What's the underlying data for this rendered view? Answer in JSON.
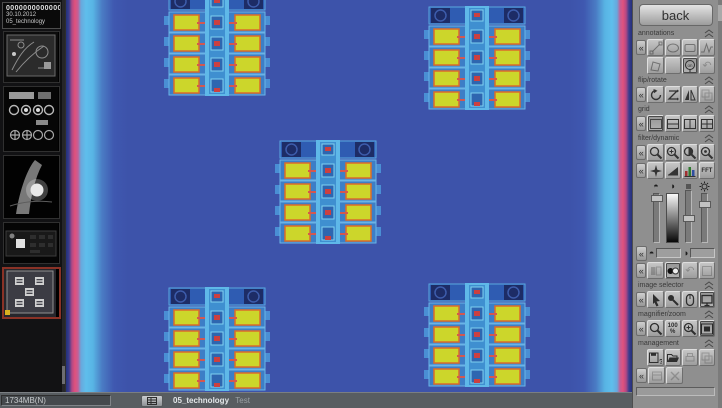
{
  "sidebar": {
    "header": {
      "barcode": "00000000000000",
      "date": "30.10.2012",
      "name": "05_technology"
    },
    "thumbnails": [
      {
        "label": "circuit-board-scan"
      },
      {
        "label": "test-pattern-scan"
      },
      {
        "label": "turbine-blade-scan"
      },
      {
        "label": "pcb-detail-scan"
      },
      {
        "label": "technology-array-scan",
        "selected": true
      }
    ]
  },
  "statusbar": {
    "memory": "1734MB(N)",
    "image_name": "05_technology",
    "image_state": "Test"
  },
  "panel": {
    "back": "back",
    "sections": {
      "annotations": "annotations",
      "flip_rotate": "flip/rotate",
      "grid": "grid",
      "filter_dynamic": "filter/dynamic",
      "image_selector": "image selector",
      "magnifier_zoom": "magnifier/zoom",
      "management": "management"
    },
    "buttons": {
      "zoom_100": "100",
      "percent": "%",
      "fft": "FFT",
      "on": "on"
    },
    "glyphs": {
      "collapse": "«",
      "undo": "↶",
      "brightness": "◓",
      "contrast": "◑",
      "question": "?"
    }
  },
  "colors": {
    "viewer_background": "#3d53aa",
    "edge_pink": "#e0517d",
    "edge_cyan": "#5fbeec",
    "pad_yellow": "#ccd62b",
    "pad_border": "#db6b2b",
    "detail_red": "#cc4040",
    "component_navy": "#1d2c66",
    "selected_thumb_border": "#8a3226",
    "panel_gray": "#8f8f8f"
  }
}
